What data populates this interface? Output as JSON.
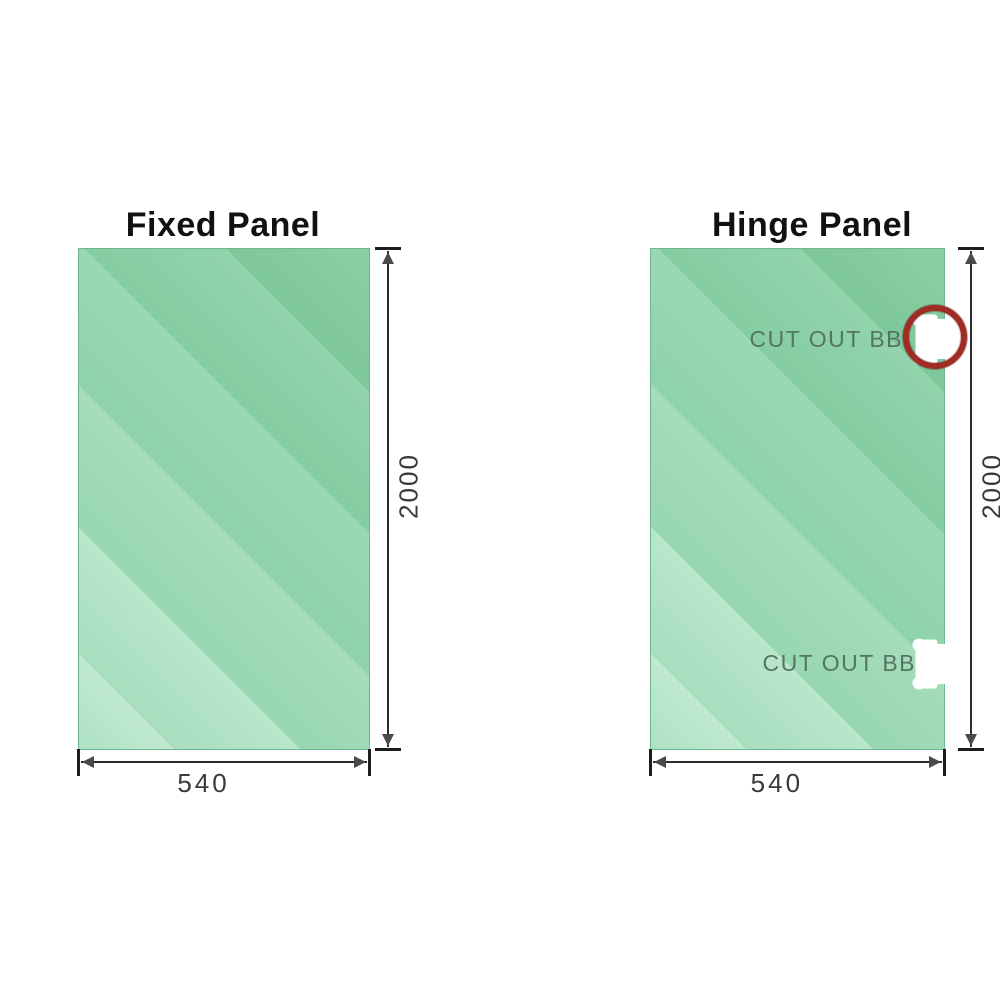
{
  "canvas": {
    "background": "#ffffff"
  },
  "colors": {
    "glass_base": "#93d5ae",
    "glass_highlight": "#bfe9d1",
    "glass_shadow": "#7ec79b",
    "dimension_line": "#2b2b2b",
    "dimension_text": "#3a3a3a",
    "title_text": "#111111",
    "cutout_label_text": "#557563",
    "cutout_fill": "#ffffff",
    "highlight_ring": "#9f2d26"
  },
  "panels": [
    {
      "id": "fixed-panel",
      "title": "Fixed Panel",
      "width_label": "540",
      "height_label": "2000",
      "cutouts": []
    },
    {
      "id": "hinge-panel",
      "title": "Hinge Panel",
      "width_label": "540",
      "height_label": "2000",
      "cutouts": [
        {
          "label": "CUT OUT BB",
          "position": "top-right",
          "highlighted": true
        },
        {
          "label": "CUT OUT BB",
          "position": "bottom-right",
          "highlighted": false
        }
      ]
    }
  ]
}
